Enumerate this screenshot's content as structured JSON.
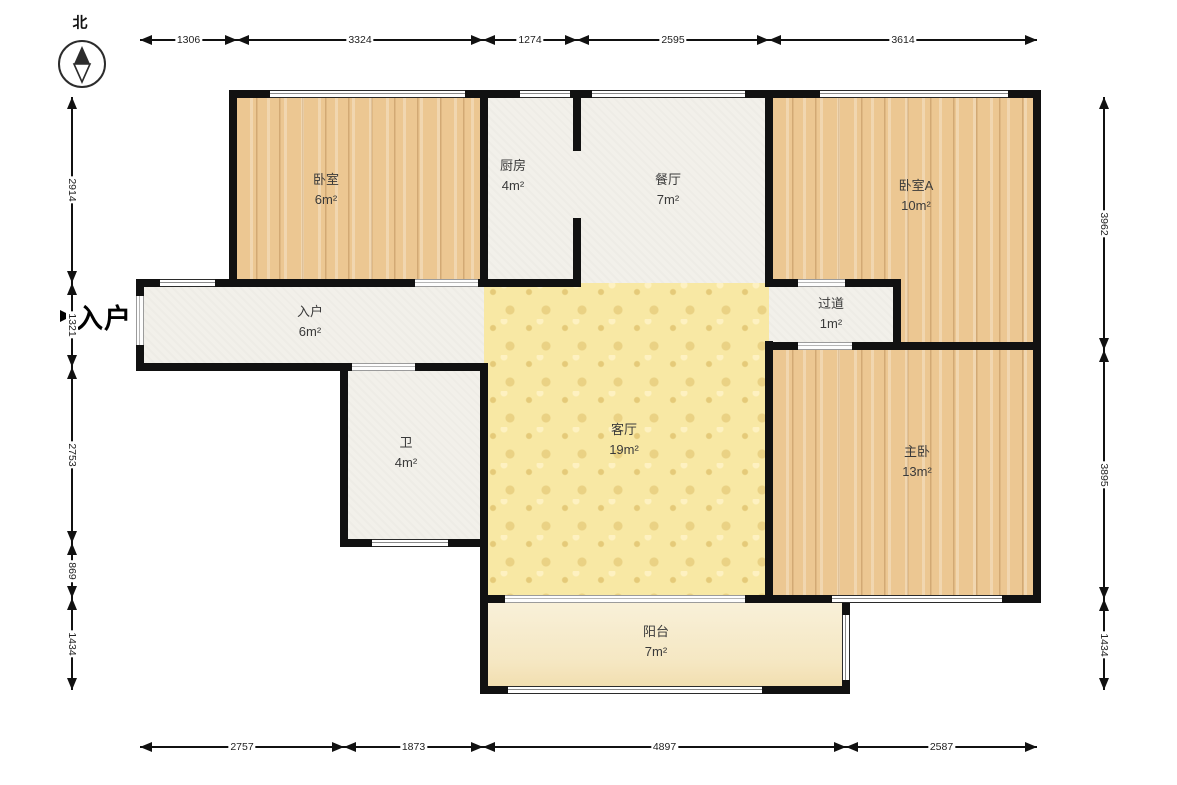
{
  "compass": {
    "label": "北"
  },
  "entrance": {
    "label": "入户"
  },
  "rooms": [
    {
      "id": "bedroom",
      "name": "卧室",
      "area": "6m²",
      "floor": "wood",
      "rect": [
        233,
        93,
        251,
        190
      ],
      "label_xy": [
        326,
        190
      ]
    },
    {
      "id": "kitchen",
      "name": "厨房",
      "area": "4m²",
      "floor": "tile",
      "rect": [
        484,
        93,
        93,
        190
      ],
      "label_xy": [
        513,
        176
      ]
    },
    {
      "id": "dining",
      "name": "餐厅",
      "area": "7m²",
      "floor": "tile",
      "rect": [
        577,
        93,
        192,
        190
      ],
      "label_xy": [
        668,
        190
      ]
    },
    {
      "id": "bedroomA",
      "name": "卧室A",
      "area": "10m²",
      "floor": "wood",
      "rect": [
        769,
        93,
        268,
        257
      ],
      "label_xy": [
        916,
        196
      ]
    },
    {
      "id": "hallway",
      "name": "过道",
      "area": "1m²",
      "floor": "tile",
      "rect": [
        769,
        283,
        128,
        66
      ],
      "label_xy": [
        831,
        314
      ]
    },
    {
      "id": "entry",
      "name": "入户",
      "area": "6m²",
      "floor": "tile",
      "rect": [
        140,
        283,
        344,
        84
      ],
      "label_xy": [
        310,
        322
      ]
    },
    {
      "id": "bath",
      "name": "卫",
      "area": "4m²",
      "floor": "tile",
      "rect": [
        344,
        367,
        140,
        176
      ],
      "label_xy": [
        406,
        453
      ]
    },
    {
      "id": "living",
      "name": "客厅",
      "area": "19m²",
      "floor": "pattern",
      "rect": [
        484,
        283,
        285,
        316
      ],
      "label_xy": [
        624,
        440
      ]
    },
    {
      "id": "master",
      "name": "主卧",
      "area": "13m²",
      "floor": "wood",
      "rect": [
        769,
        350,
        268,
        249
      ],
      "label_xy": [
        917,
        462
      ]
    },
    {
      "id": "balcony",
      "name": "阳台",
      "area": "7m²",
      "floor": "cream",
      "rect": [
        484,
        599,
        362,
        91
      ],
      "label_xy": [
        656,
        642
      ]
    }
  ],
  "walls": [
    [
      230,
      90,
      811,
      8
    ],
    [
      136,
      279,
      445,
      8
    ],
    [
      766,
      279,
      135,
      8
    ],
    [
      766,
      342,
      275,
      8
    ],
    [
      136,
      363,
      352,
      8
    ],
    [
      340,
      539,
      148,
      8
    ],
    [
      480,
      595,
      561,
      8
    ],
    [
      480,
      686,
      370,
      8
    ],
    [
      136,
      279,
      8,
      92
    ],
    [
      229,
      90,
      8,
      197
    ],
    [
      480,
      90,
      8,
      197
    ],
    [
      573,
      90,
      8,
      61
    ],
    [
      573,
      218,
      8,
      69
    ],
    [
      765,
      90,
      8,
      197
    ],
    [
      765,
      341,
      8,
      262
    ],
    [
      340,
      363,
      8,
      184
    ],
    [
      480,
      363,
      8,
      331
    ],
    [
      893,
      279,
      8,
      71
    ],
    [
      1033,
      90,
      8,
      513
    ],
    [
      842,
      595,
      8,
      99
    ]
  ],
  "windows": [
    {
      "rect": [
        270,
        90,
        195,
        8
      ],
      "orient": "h"
    },
    {
      "rect": [
        520,
        90,
        50,
        8
      ],
      "orient": "h"
    },
    {
      "rect": [
        592,
        90,
        153,
        8
      ],
      "orient": "h"
    },
    {
      "rect": [
        820,
        90,
        188,
        8
      ],
      "orient": "h"
    },
    {
      "rect": [
        160,
        279,
        55,
        8
      ],
      "orient": "h"
    },
    {
      "rect": [
        372,
        539,
        76,
        8
      ],
      "orient": "h"
    },
    {
      "rect": [
        832,
        595,
        170,
        8
      ],
      "orient": "h"
    },
    {
      "rect": [
        508,
        686,
        254,
        8
      ],
      "orient": "h"
    },
    {
      "rect": [
        842,
        615,
        8,
        65
      ],
      "orient": "v"
    }
  ],
  "doors": [
    {
      "rect": [
        415,
        279,
        63,
        8
      ],
      "orient": "h"
    },
    {
      "rect": [
        798,
        279,
        47,
        8
      ],
      "orient": "h"
    },
    {
      "rect": [
        798,
        342,
        54,
        8
      ],
      "orient": "h"
    },
    {
      "rect": [
        352,
        363,
        63,
        8
      ],
      "orient": "h"
    },
    {
      "rect": [
        505,
        595,
        240,
        8
      ],
      "orient": "h"
    },
    {
      "rect": [
        136,
        296,
        8,
        49
      ],
      "orient": "v"
    }
  ],
  "dimensions": [
    {
      "id": "top",
      "orient": "h",
      "pos": 40,
      "segments": [
        {
          "a": 140,
          "b": 237,
          "label": "1306"
        },
        {
          "a": 237,
          "b": 483,
          "label": "3324"
        },
        {
          "a": 483,
          "b": 577,
          "label": "1274"
        },
        {
          "a": 577,
          "b": 769,
          "label": "2595"
        },
        {
          "a": 769,
          "b": 1037,
          "label": "3614"
        }
      ]
    },
    {
      "id": "bottom",
      "orient": "h",
      "pos": 747,
      "segments": [
        {
          "a": 140,
          "b": 344,
          "label": "2757"
        },
        {
          "a": 344,
          "b": 483,
          "label": "1873"
        },
        {
          "a": 483,
          "b": 846,
          "label": "4897"
        },
        {
          "a": 846,
          "b": 1037,
          "label": "2587"
        }
      ]
    },
    {
      "id": "left",
      "orient": "v",
      "pos": 72,
      "segments": [
        {
          "a": 97,
          "b": 283,
          "label": "2914"
        },
        {
          "a": 283,
          "b": 367,
          "label": "1321"
        },
        {
          "a": 367,
          "b": 543,
          "label": "2753"
        },
        {
          "a": 543,
          "b": 598,
          "label": "869"
        },
        {
          "a": 598,
          "b": 690,
          "label": "1434"
        }
      ]
    },
    {
      "id": "right",
      "orient": "v",
      "pos": 1104,
      "segments": [
        {
          "a": 97,
          "b": 350,
          "label": "3962"
        },
        {
          "a": 350,
          "b": 599,
          "label": "3895"
        },
        {
          "a": 599,
          "b": 690,
          "label": "1434"
        }
      ]
    }
  ]
}
